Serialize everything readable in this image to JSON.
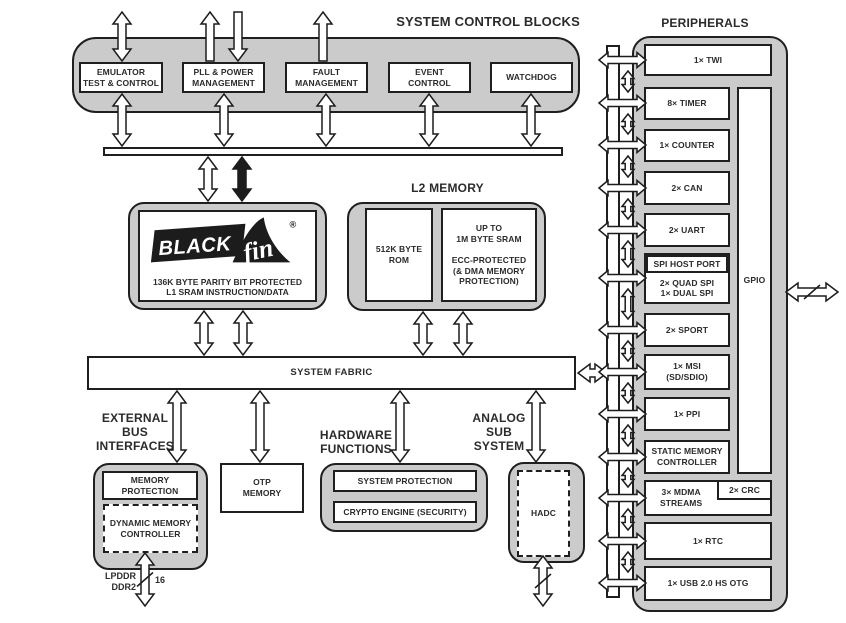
{
  "diagram_title": "Processor functional block diagram",
  "colors": {
    "container_gray": "#cbcbcb",
    "box_white": "#ffffff",
    "line_black": "#1f1f1f",
    "text": "#2b2b2b"
  },
  "system_control": {
    "label": "SYSTEM CONTROL BLOCKS",
    "emulator": "EMULATOR\nTEST & CONTROL",
    "pll": "PLL & POWER\nMANAGEMENT",
    "fault": "FAULT\nMANAGEMENT",
    "event": "EVENT\nCONTROL",
    "watchdog": "WATCHDOG"
  },
  "core": {
    "logo_black": "BLACK",
    "logo_fin": "fin",
    "logo_reg": "®",
    "label": "136K BYTE PARITY BIT PROTECTED\nL1 SRAM INSTRUCTION/DATA"
  },
  "l2_memory": {
    "label": "L2 MEMORY",
    "rom": "512K BYTE\nROM",
    "sram": "UP TO\n1M BYTE SRAM\n\nECC-PROTECTED\n(& DMA MEMORY\nPROTECTION)"
  },
  "system_fabric": {
    "label": "SYSTEM FABRIC"
  },
  "external_bus": {
    "label": "EXTERNAL\nBUS\nINTERFACES",
    "memory_protection": "MEMORY\nPROTECTION",
    "dynamic_memory_controller": "DYNAMIC MEMORY\nCONTROLLER",
    "ddr_types": "LPDDR\nDDR2",
    "bus_width": "16"
  },
  "otp": {
    "label": "OTP\nMEMORY"
  },
  "hardware_functions": {
    "label": "HARDWARE\nFUNCTIONS",
    "system_protection": "SYSTEM PROTECTION",
    "crypto_engine": "CRYPTO ENGINE (SECURITY)"
  },
  "analog_subsystem": {
    "label": "ANALOG\nSUB\nSYSTEM",
    "hadc": "HADC"
  },
  "peripherals": {
    "label": "PERIPHERALS",
    "twi": "1× TWI",
    "timer": "8× TIMER",
    "counter": "1× COUNTER",
    "can": "2× CAN",
    "uart": "2× UART",
    "spi_host_port": "SPI HOST PORT",
    "spi_detail": "2× QUAD SPI\n1× DUAL SPI",
    "sport": "2× SPORT",
    "msi": "1× MSI\n(SD/SDIO)",
    "ppi": "1× PPI",
    "static_memory_controller": "STATIC MEMORY\nCONTROLLER",
    "mdma": "3× MDMA\nSTREAMS",
    "crc": "2× CRC",
    "gpio": "GPIO",
    "rtc": "1× RTC",
    "usb": "1× USB 2.0 HS OTG"
  }
}
